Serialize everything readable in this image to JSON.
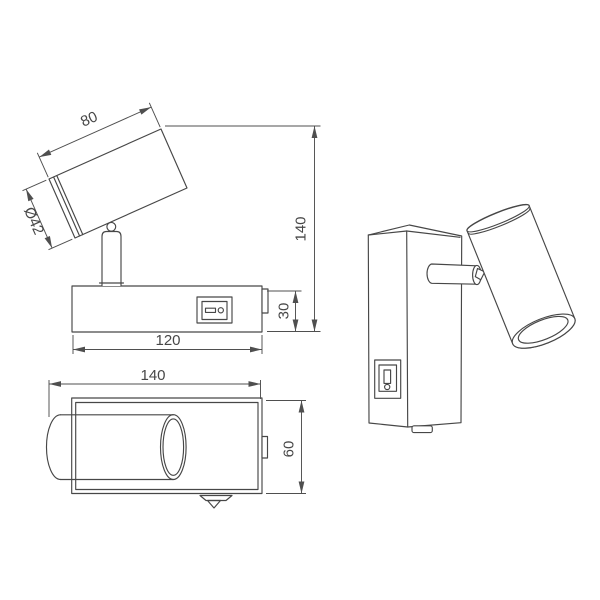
{
  "colors": {
    "background": "#ffffff",
    "line": "#474747",
    "text": "#474747"
  },
  "views": {
    "side_view": {
      "dim_head_length": "80",
      "dim_head_diameter": "Ø42",
      "dim_total_height": "140",
      "dim_base_height": "30",
      "dim_base_width": "120"
    },
    "top_view": {
      "dim_overall_width": "140",
      "dim_overall_depth": "60"
    }
  }
}
